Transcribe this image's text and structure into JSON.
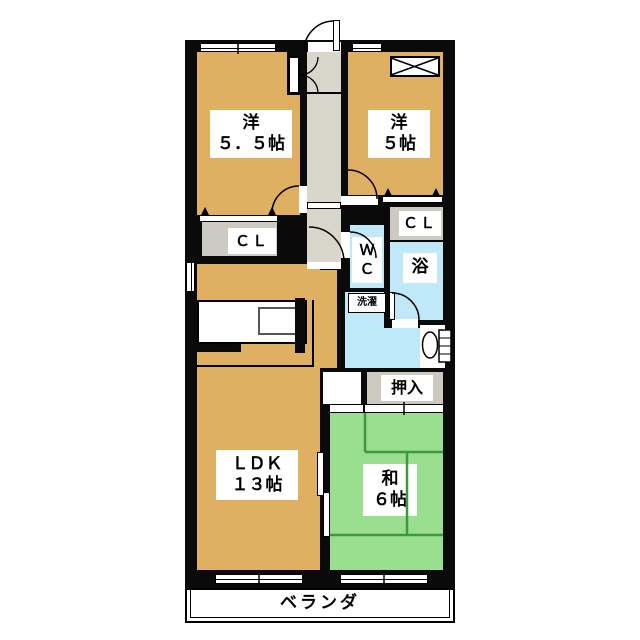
{
  "floorplan": {
    "title": "apartment-floor-plan",
    "rooms": {
      "west_bedroom_1": {
        "name": "洋",
        "size": "５．５帖"
      },
      "west_bedroom_2": {
        "name": "洋",
        "size": "５帖"
      },
      "ldk": {
        "name": "ＬＤＫ",
        "size": "１３帖"
      },
      "japanese_room": {
        "name": "和",
        "size": "６帖"
      },
      "closet_left": {
        "label": "ＣＬ"
      },
      "closet_right": {
        "label": "ＣＬ"
      },
      "wc": {
        "line1": "Ｗ",
        "line2": "Ｃ"
      },
      "bath": {
        "label": "浴"
      },
      "laundry": {
        "label": "洗濯"
      },
      "oshiire": {
        "label": "押入"
      },
      "veranda": {
        "label": "ベランダ"
      }
    },
    "colors": {
      "wall": "#0a0a0a",
      "wood_floor": "#dfaf62",
      "tatami_green": "#9ade90",
      "tatami_line": "#3c9a3c",
      "wet_area_blue": "#bfe9f8",
      "corridor_gray": "#d9d6cb",
      "closet_gray": "#cdcac3",
      "background": "#ffffff"
    }
  }
}
